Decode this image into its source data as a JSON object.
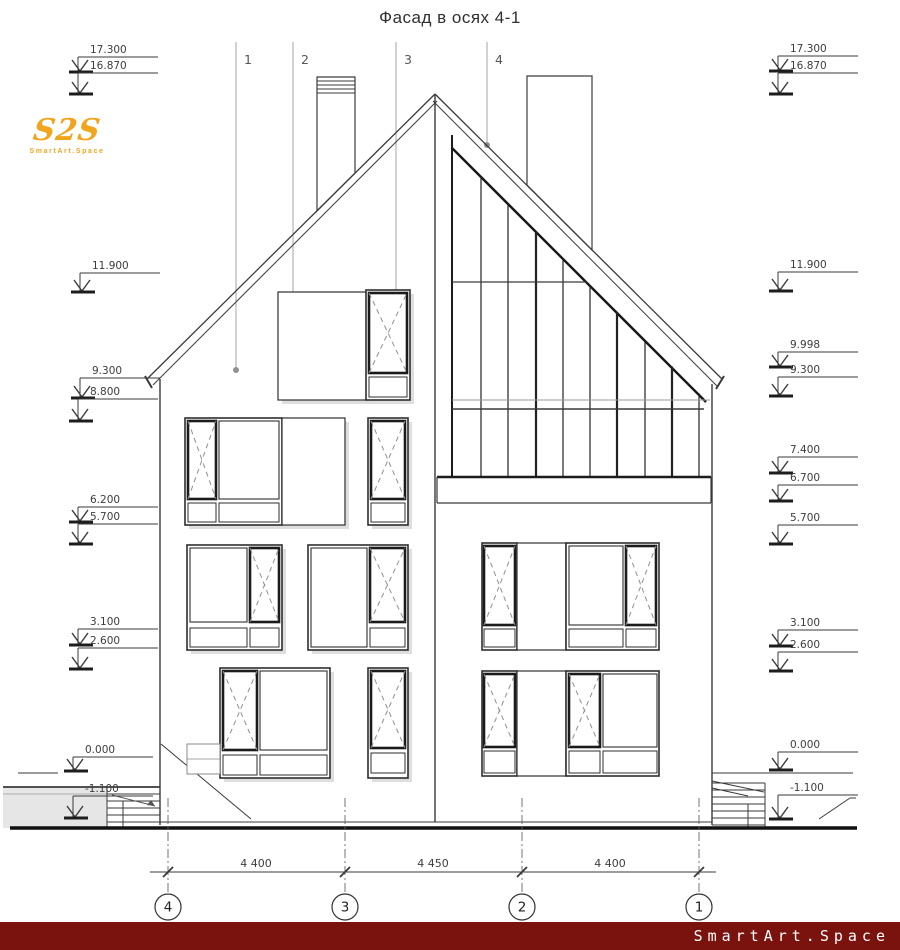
{
  "title": "Фасад в осях 4-1",
  "logo": {
    "mark": "S2S",
    "caption": "SmartArt.Space"
  },
  "footer": {
    "text": "SmartArt.Space"
  },
  "leaders": [
    "1",
    "2",
    "3",
    "4"
  ],
  "levels": {
    "left": [
      "17.300",
      "16.870",
      "11.900",
      "9.300",
      "8.800",
      "6.200",
      "5.700",
      "3.100",
      "2.600",
      "0.000",
      "-1.100"
    ],
    "right": [
      "17.300",
      "16.870",
      "11.900",
      "9.998",
      "9.300",
      "7.400",
      "6.700",
      "5.700",
      "3.100",
      "2.600",
      "0.000",
      "-1.100"
    ]
  },
  "dimensions": [
    "4 400",
    "4 450",
    "4 400"
  ],
  "axes": [
    "4",
    "3",
    "2",
    "1"
  ],
  "colors": {
    "logo_accent": "#f0a51d",
    "footer_bg": "#7a130e",
    "line_dark": "#2e2e2e",
    "line_gray": "#8a8a8a",
    "ground_fill": "#e6e6e6"
  }
}
